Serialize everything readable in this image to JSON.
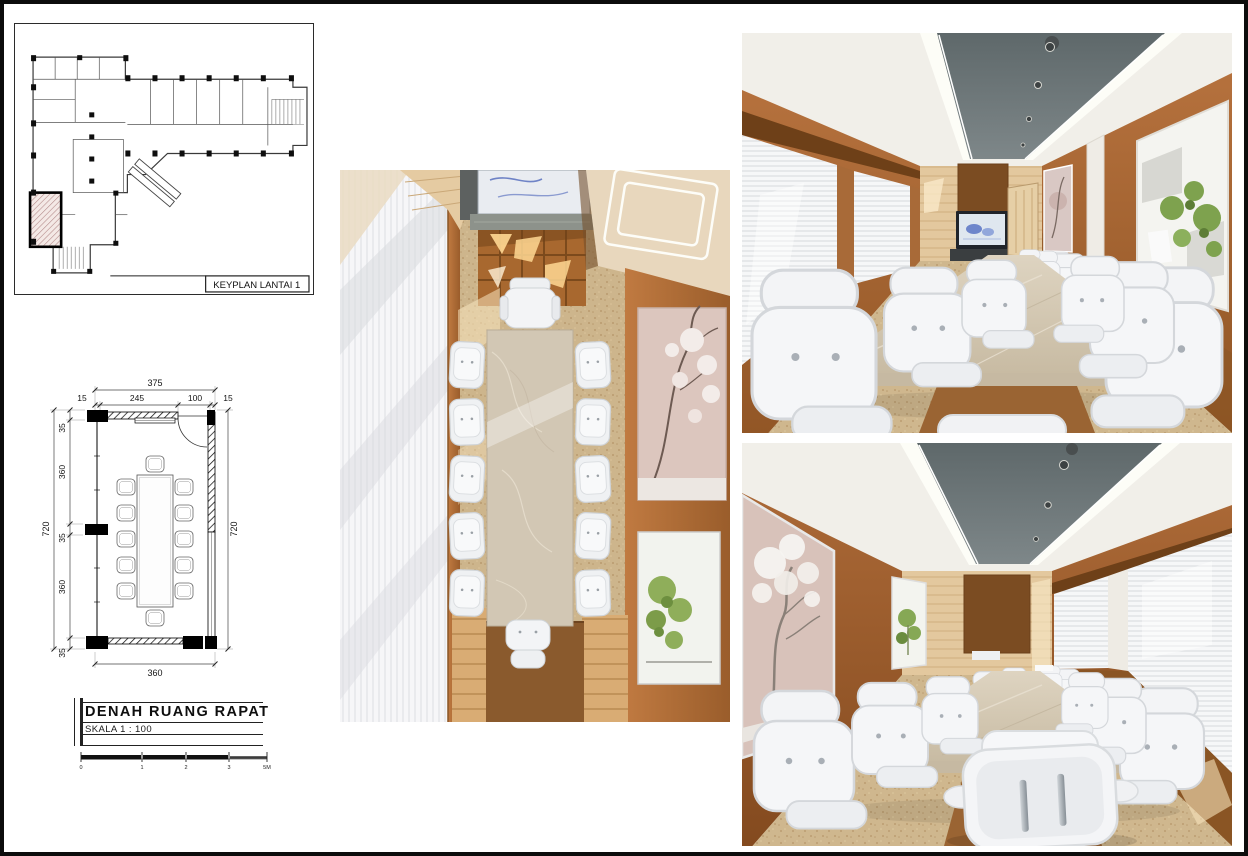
{
  "sheet": {
    "background": "#ffffff",
    "frame_color": "#0c0c0c"
  },
  "keyplan": {
    "label": "KEYPLAN LANTAI 1"
  },
  "floor_plan": {
    "dims": {
      "top_total": "375",
      "top_segments": [
        "15",
        "245",
        "100",
        "15"
      ],
      "left_total": "720",
      "left_segments": [
        "35",
        "360",
        "35",
        "360",
        "35"
      ],
      "right_total": "720",
      "bottom_width": "360"
    },
    "furniture": {
      "chair_count": 12
    }
  },
  "title_block": {
    "title": "DENAH RUANG RAPAT",
    "scale": "SKALA 1 : 100",
    "scale_bar": {
      "ticks": [
        "0",
        "1",
        "2",
        "3"
      ],
      "end_label": "5M"
    }
  },
  "colors": {
    "wood_wall": "#a9693a",
    "light_wood": "#e0c59c",
    "ceiling_gray": "#66706f",
    "marble_table": "#d2c7b4",
    "chair_white": "#f2f3f5",
    "floor_cork": "#cdb68c",
    "highlight_hatch": "#b08585",
    "line_black": "#1a1a1a"
  }
}
